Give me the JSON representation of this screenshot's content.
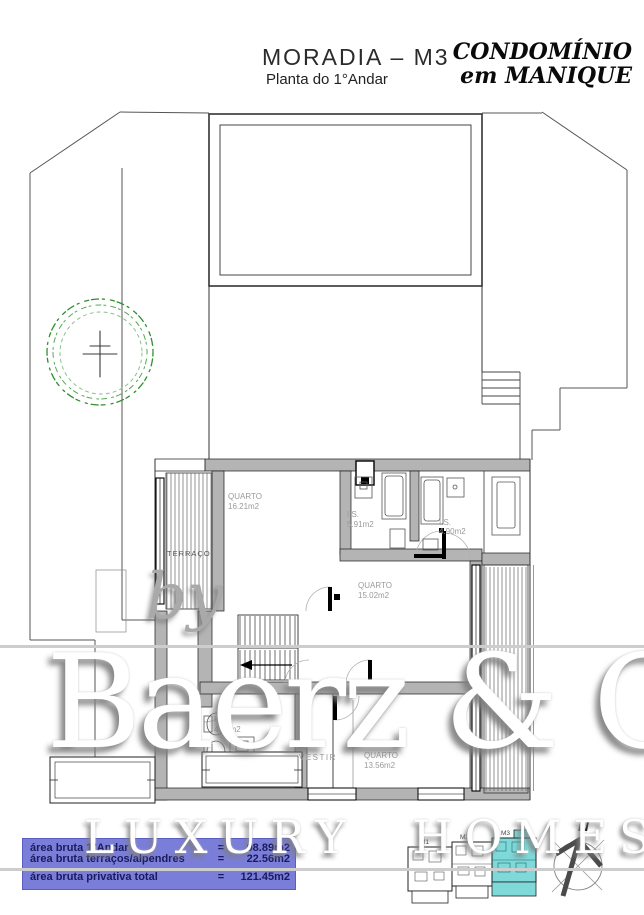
{
  "header": {
    "title": "MORADIA – M3",
    "subtitle": "Planta do 1°Andar"
  },
  "brand": {
    "line1": "CONDOMÍNIO",
    "line2": "em MANIQUE"
  },
  "plan": {
    "terrace_left": "TERRAÇO",
    "rooms": [
      {
        "name": "QUARTO",
        "area": "16.21m2"
      },
      {
        "name": "I.S.",
        "area": "5.91m2"
      },
      {
        "name": "I.S.",
        "area": "4.90m2"
      },
      {
        "name": "QUARTO",
        "area": "15.02m2"
      },
      {
        "name": "QUARTO",
        "area": "13.56m2"
      },
      {
        "name": "I.S.",
        "area": "4.62m2"
      },
      {
        "name": "VESTIR",
        "area": ""
      }
    ]
  },
  "watermark": {
    "prefix": "by",
    "name": "Baerz & Co",
    "tagline": "LUXURY HOMES"
  },
  "area_table": {
    "equals": "=",
    "bg_color": "#7a7ed8",
    "rows": [
      {
        "label": "área bruta 1°Andar",
        "value": "98.89m2"
      },
      {
        "label": "área bruta terraços/alpendres",
        "value": "22.56m2"
      },
      {
        "label": "área bruta privativa total",
        "value": "121.45m2"
      }
    ]
  },
  "key_plan": {
    "units": [
      "M1",
      "M2",
      "M3"
    ],
    "highlighted_unit": "M3",
    "highlight_color": "#7fd9d9"
  },
  "compass": {
    "north_label": "N"
  },
  "colors": {
    "wall_fill": "#b4b4b4",
    "tree_green": "#2f8f2f"
  }
}
